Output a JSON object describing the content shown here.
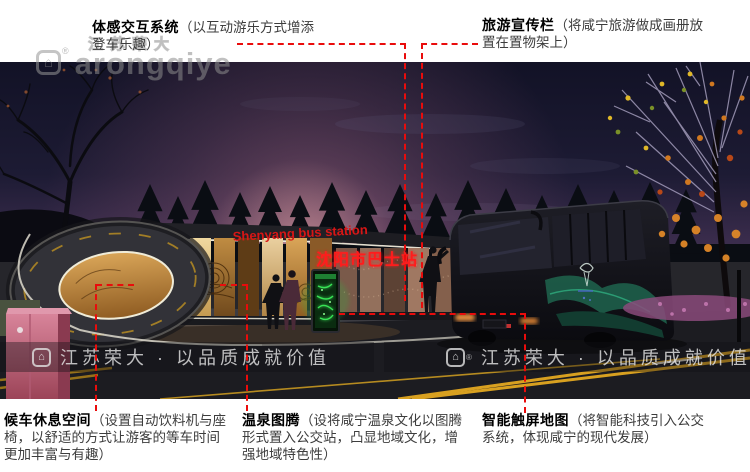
{
  "annotations": {
    "interaction": {
      "title": "体感交互系统",
      "desc": "（以互动游乐方式增添\n登车乐趣）"
    },
    "tourism": {
      "title": "旅游宣传栏",
      "desc": "（将咸宁旅游做成画册放\n置在置物架上）"
    },
    "waiting": {
      "title": "候车休息空间",
      "desc": "（设置自动饮料机与座\n椅，以舒适的方式让游客的等车时间\n更加丰富与有趣）"
    },
    "totem": {
      "title": "温泉图腾",
      "desc": "（设将咸宁温泉文化以图腾\n形式置入公交站，凸显地域文化，增\n强地域特色性）"
    },
    "touchmap": {
      "title": "智能触屏地图",
      "desc": "（将智能科技引入公交\n系统，体现咸宁的现代发展）"
    }
  },
  "scene": {
    "station_sign_en": "Shenyang bus station",
    "station_sign_zh": "沈阳市巴士站"
  },
  "watermarks": {
    "top_outline": "江苏荣大",
    "top_brand": "arongqiye",
    "bottom_left": "江苏荣大 · 以品质成就价值",
    "bottom_right": "江苏荣大 · 以品质成就价值",
    "registered": "®",
    "logo_glyph": "⌂"
  },
  "colors": {
    "annotation_red": "#e90c0c",
    "sign_red": "#ff1e1e",
    "glass_amber": "#d9a558",
    "screen_green": "#38e455",
    "sky_navy": "#15152a",
    "glow_pink": "#c87a92"
  }
}
